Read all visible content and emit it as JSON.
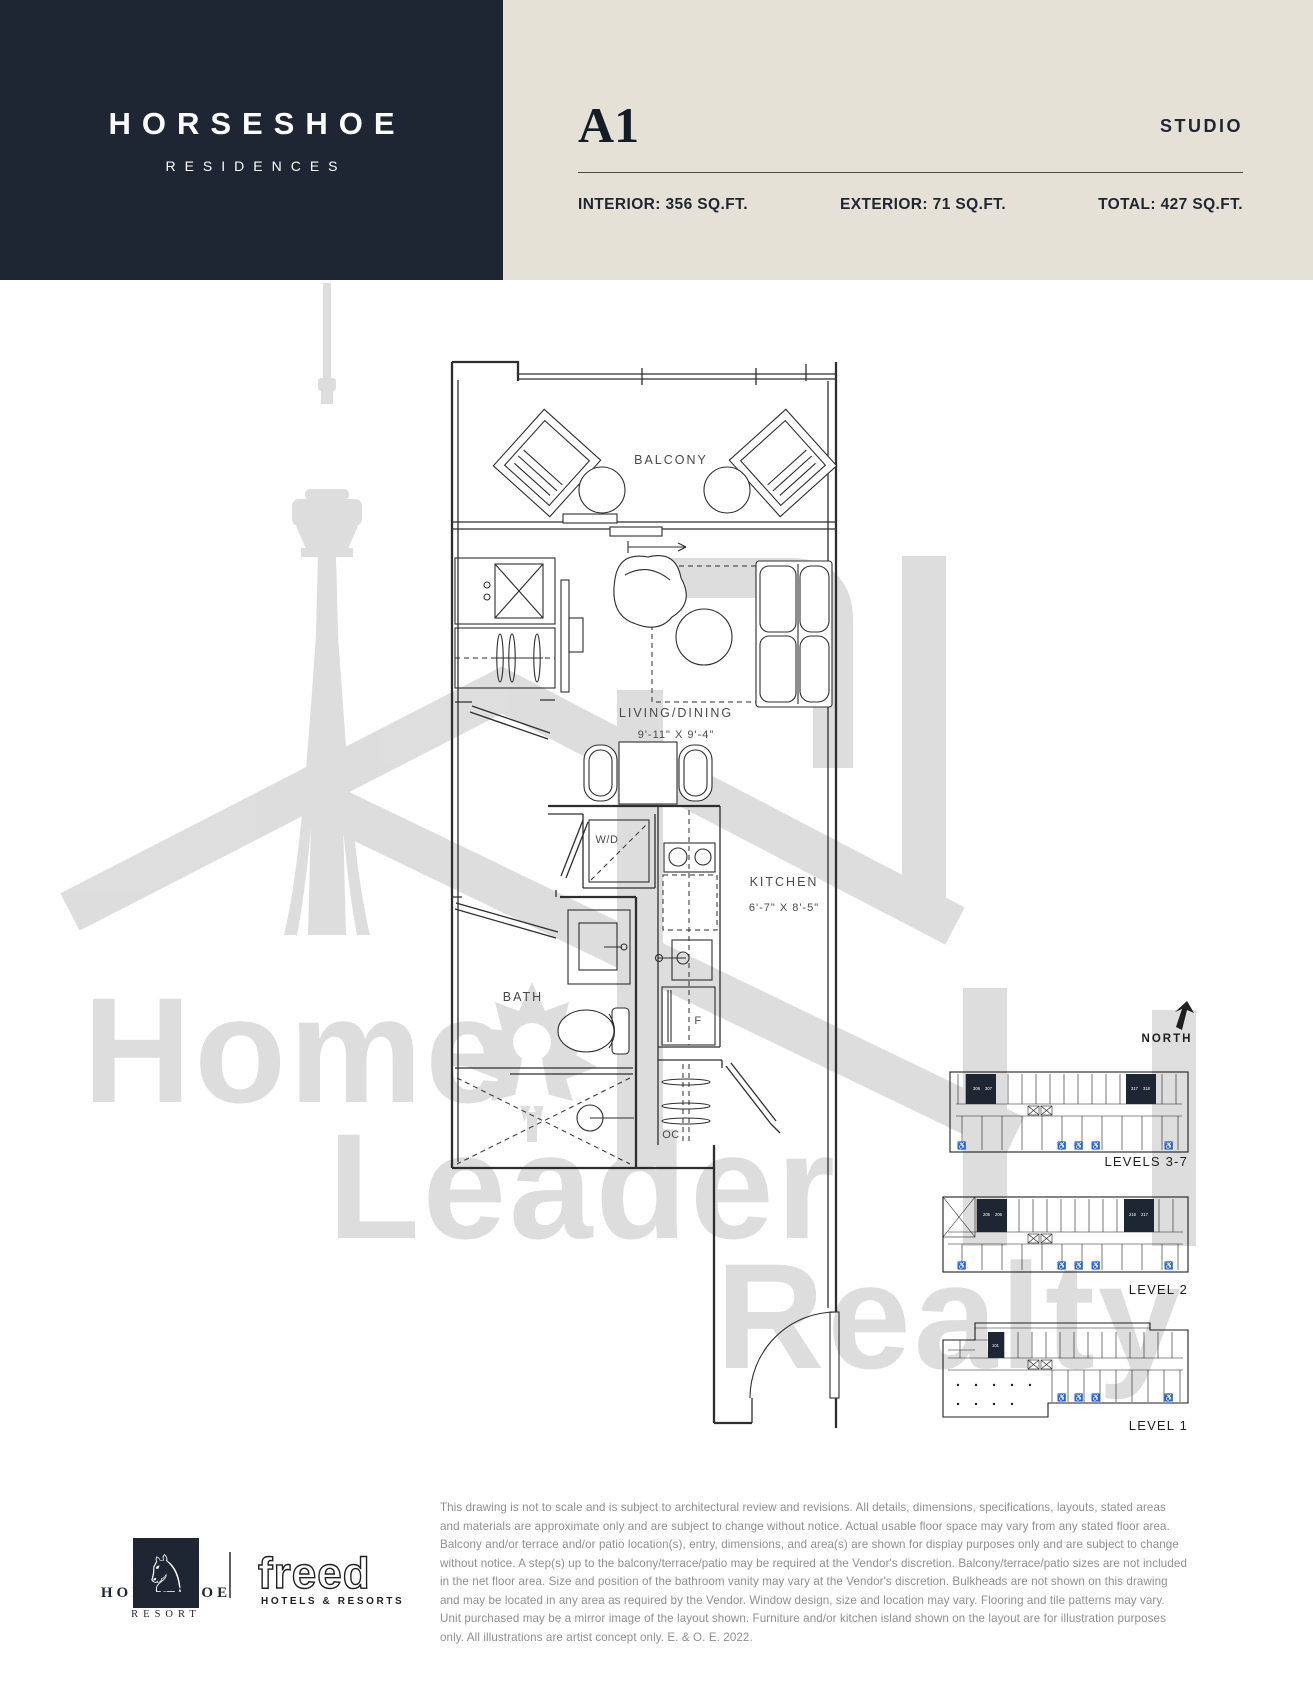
{
  "header": {
    "brand": "HORSESHOE",
    "brand_sub": "RESIDENCES",
    "unit": "A1",
    "unit_type": "STUDIO",
    "interior": "INTERIOR: 356 SQ.FT.",
    "exterior": "EXTERIOR: 71 SQ.FT.",
    "total": "TOTAL: 427 SQ.FT."
  },
  "plan": {
    "balcony": "BALCONY",
    "living": "LIVING/DINING",
    "living_dim": "9'-11\" X 9'-4\"",
    "kitchen": "KITCHEN",
    "kitchen_dim": "6'-7\" X 8'-5\"",
    "bath": "BATH",
    "washer_dryer": "W/D",
    "fridge": "F",
    "open_closet": "OC"
  },
  "compass": {
    "label": "NORTH"
  },
  "keyplans": {
    "levels37": {
      "label": "LEVELS 3-7",
      "units_left": [
        "306",
        "307"
      ],
      "units_right": [
        "317",
        "318"
      ]
    },
    "level2": {
      "label": "LEVEL 2",
      "units_left": [
        "205",
        "206"
      ],
      "units_right": [
        "216",
        "217"
      ]
    },
    "level1": {
      "label": "LEVEL 1",
      "units_left": [
        "101"
      ]
    }
  },
  "icons": {
    "wheelchair": "♿",
    "horse": "♘"
  },
  "watermark": {
    "line1": "Home",
    "line2": "Leader",
    "line3": "Realty"
  },
  "disclaimer": "This drawing is not to scale and is subject to architectural review and revisions. All details, dimensions, specifications, layouts, stated areas and materials are approximate only and are subject to change without notice. Actual usable floor space may vary from any stated floor area. Balcony and/or terrace and/or patio location(s), entry, dimensions, and area(s) are shown for display purposes only and are subject to change without notice. A step(s) up to the balcony/terrace/patio may be required at the Vendor's discretion. Balcony/terrace/patio sizes are not included in the net floor area. Size and position of the bathroom vanity may vary at the Vendor's discretion. Bulkheads are not shown on this drawing and may be located in any area as required by the Vendor. Window design, size and location may vary. Flooring and tile patterns may vary. Unit purchased may be a mirror image of the layout shown. Furniture and/or kitchen island shown on the layout are for illustration purposes only. All illustrations are artist concept only. E. & O. E. 2022.",
  "footer": {
    "resort_name": "HORSESHOE",
    "resort_sub": "RESORT",
    "partner": "freed",
    "partner_sub": "HOTELS & RESORTS"
  },
  "colors": {
    "navy": "#1d2632",
    "beige": "#e5e1d6",
    "line": "#2e2e2e",
    "label": "#4a4a4a",
    "watermark": "#dadada",
    "muted": "#8f8f8f"
  }
}
